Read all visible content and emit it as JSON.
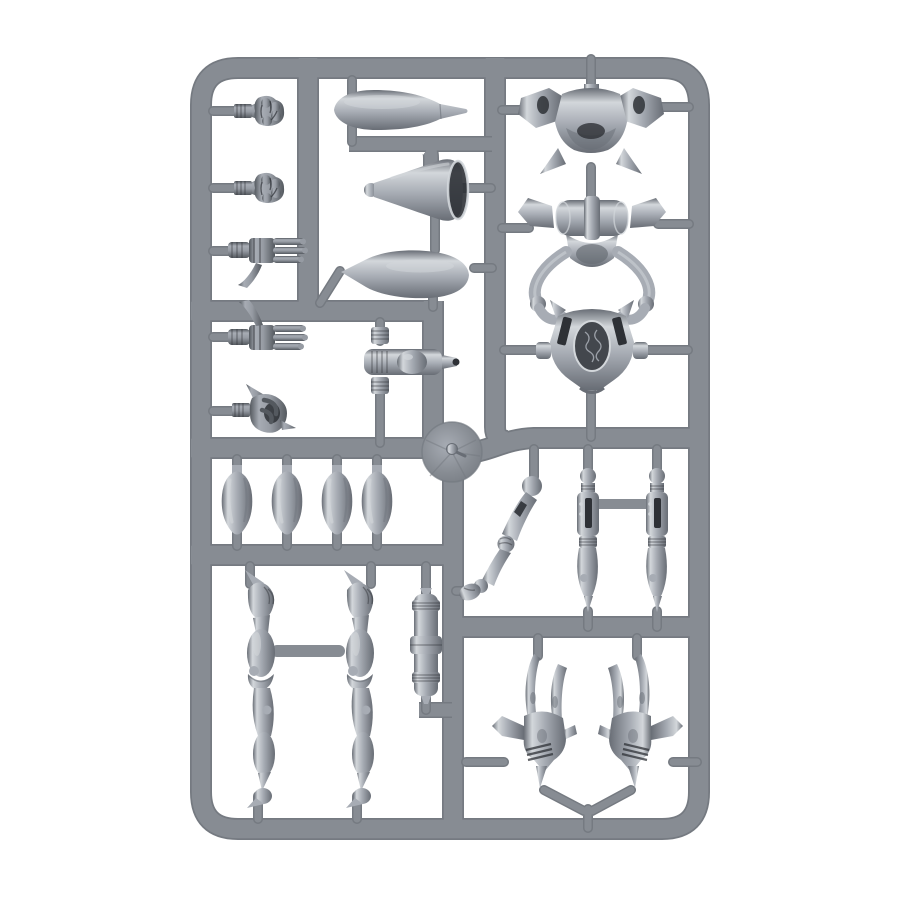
{
  "photo": {
    "alt": "Grey plastic model kit sprue with robot walker miniature parts photographed on a white background",
    "background": "#ffffff",
    "colors": {
      "bg": "#ffffff",
      "rail": "#878c93",
      "rail_dark": "#757a81",
      "part_hi": "#d3d7db",
      "part_base": "#a7acb4",
      "part_dk": "#686d75",
      "hand_base": "#969ba3",
      "hand_dk": "#54595f",
      "recess": "#2e3136"
    },
    "parts": [
      {
        "name": "clenched-fist",
        "count": 2,
        "area": "top-left column"
      },
      {
        "name": "open-hand",
        "count": 2,
        "area": "left column"
      },
      {
        "name": "gripping-hand",
        "count": 1,
        "area": "left column"
      },
      {
        "name": "fuselage-body",
        "count": 2,
        "area": "top middle column"
      },
      {
        "name": "bell-horn",
        "count": 1,
        "area": "top middle column"
      },
      {
        "name": "ribbed-pistol",
        "count": 1,
        "area": "middle column"
      },
      {
        "name": "winged-torso-plate",
        "count": 1,
        "area": "top right"
      },
      {
        "name": "waist-joint-with-pods",
        "count": 1,
        "area": "top right"
      },
      {
        "name": "chest-plate-medallion",
        "count": 1,
        "area": "right, hung on ring arms"
      },
      {
        "name": "injection-disc",
        "count": 1,
        "area": "center"
      },
      {
        "name": "shoulder-pad-shell",
        "count": 4,
        "area": "middle-left row"
      },
      {
        "name": "long-leg",
        "count": 2,
        "area": "bottom left"
      },
      {
        "name": "ribbed-cylinder",
        "count": 1,
        "area": "bottom middle"
      },
      {
        "name": "bent-arm",
        "count": 1,
        "area": "middle right"
      },
      {
        "name": "thigh-piston",
        "count": 2,
        "area": "middle right"
      },
      {
        "name": "claw-foot",
        "count": 2,
        "area": "bottom right"
      }
    ]
  }
}
